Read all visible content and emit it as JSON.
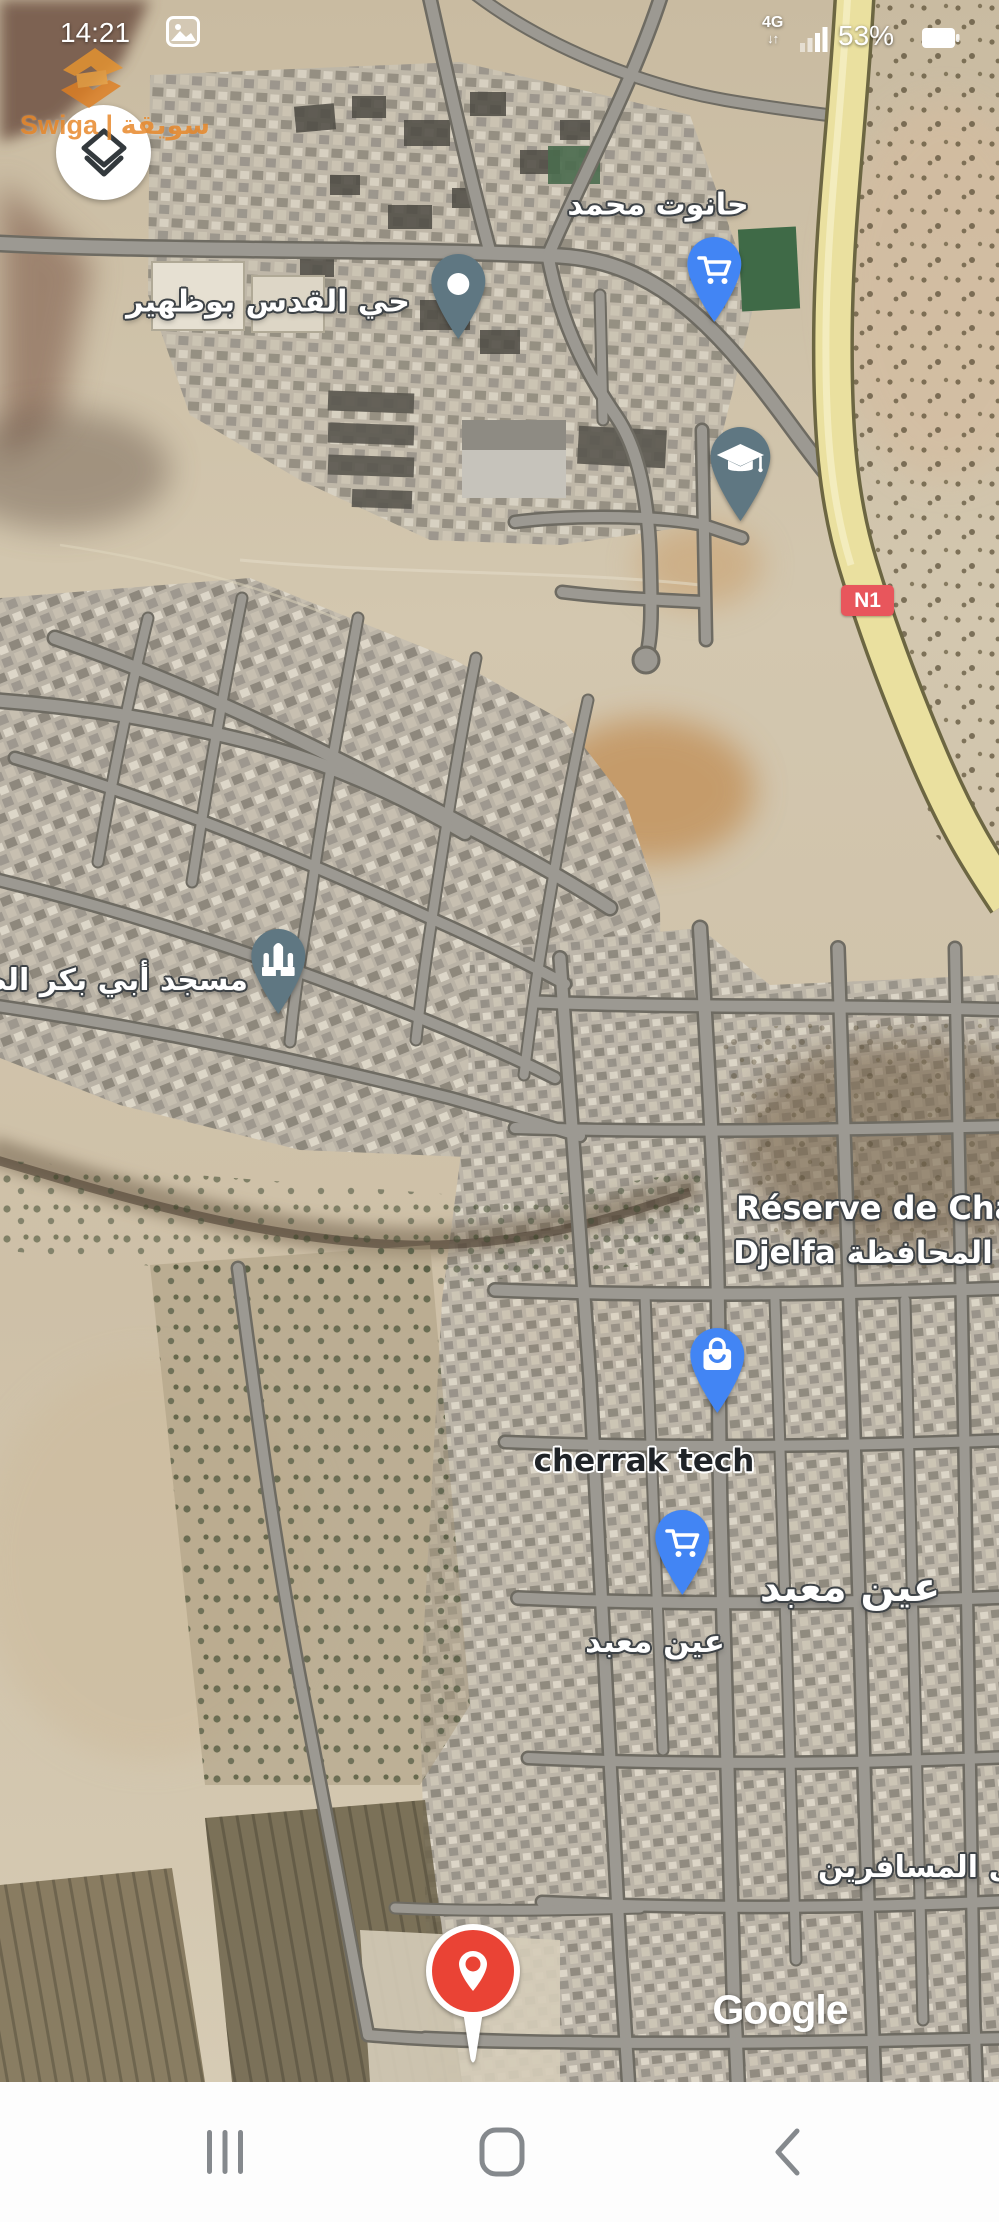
{
  "status_bar": {
    "time": "14:21",
    "notification_icon": "photo",
    "network_type": "4G",
    "battery_percent": "53%"
  },
  "watermark": {
    "brand": "Swiga | سويقة",
    "accent_color": "#e8892c"
  },
  "map": {
    "kind": "google-maps-satellite",
    "attribution": "Google",
    "road_badge": {
      "text": "N1",
      "color": "#e8565c",
      "road_color": "#eae09f"
    },
    "labels": {
      "hanout": {
        "text": "حانوت محمد"
      },
      "qods": {
        "text": "حي القدس بوظهير"
      },
      "mosque": {
        "text": "مسجد أبي بكر الصديق"
      },
      "reserve_line1": {
        "text": "Réserve de Chasse"
      },
      "reserve_line2": {
        "text": "Djelfa المحافظة"
      },
      "cherrak": {
        "text": "cherrak tech"
      },
      "ain_maabed_town": {
        "text": "عين معبد"
      },
      "ain_maabed_poi": {
        "text": "عين معبد"
      },
      "musafirin": {
        "text": "نزل المسافرين"
      }
    },
    "pins": {
      "colors": {
        "poi_slate": "#5f7782",
        "shop_blue": "#4285f4",
        "destination_red": "#ea4335"
      },
      "items": [
        {
          "name": "shop-cart-pin-hanout",
          "icon": "cart-icon",
          "color": "#4285f4"
        },
        {
          "name": "neighborhood-pin-qods",
          "icon": "dot-icon",
          "color": "#5f7782"
        },
        {
          "name": "school-pin",
          "icon": "graduation-cap-icon",
          "color": "#5f7782"
        },
        {
          "name": "mosque-pin",
          "icon": "mosque-icon",
          "color": "#5f7782"
        },
        {
          "name": "shop-bag-pin-cherrak",
          "icon": "shopping-bag-icon",
          "color": "#4285f4"
        },
        {
          "name": "shop-cart-pin-ain-maabed",
          "icon": "cart-icon",
          "color": "#4285f4"
        },
        {
          "name": "destination-pin",
          "icon": "place-pin-icon",
          "color": "#ea4335"
        }
      ]
    }
  },
  "nav_bar": {
    "recents": "recents",
    "home": "home",
    "back": "back"
  }
}
